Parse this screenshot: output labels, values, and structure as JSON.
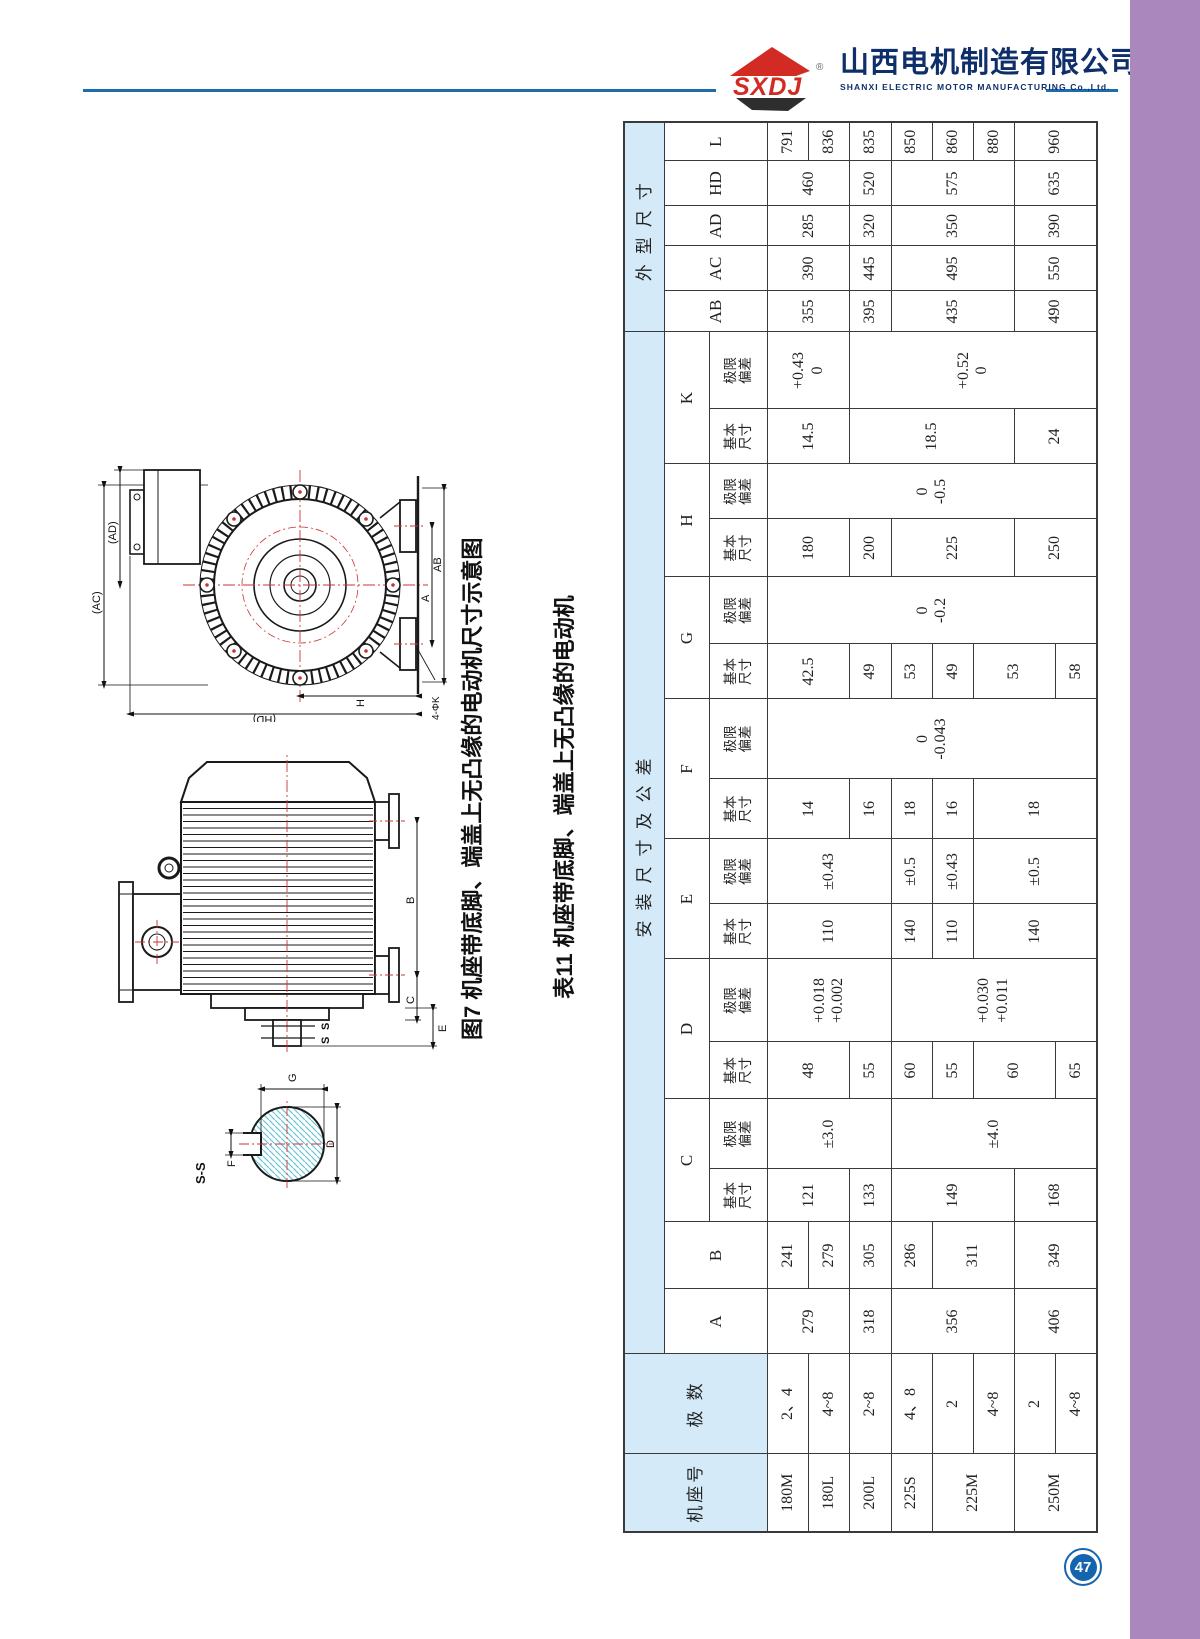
{
  "header": {
    "logo_text": "SXDJ",
    "reg_mark": "®",
    "company_cn": "山西电机制造有限公司",
    "company_en": "SHANXI ELECTRIC MOTOR MANUFACTURING Co.,Ltd.",
    "rule_color": "#1d6dad",
    "logo_red": "#d22b23",
    "logo_dark": "#2e2e2e",
    "text_navy": "#0f2f6b"
  },
  "figure": {
    "caption": "图7 机座带底脚、端盖上无凸缘的电动机尺寸示意图",
    "end_view_labels": {
      "ac": "(AC)",
      "ad": "(AD)",
      "hd": "(HD)",
      "h": "H",
      "a": "A",
      "ab": "AB",
      "k": "4-ΦK"
    },
    "side_view_labels": {
      "b": "B",
      "c": "C",
      "e": "E",
      "s1": "S",
      "s2": "S"
    },
    "section_labels": {
      "title": "S-S",
      "f": "F",
      "g": "G",
      "d": "D"
    }
  },
  "table": {
    "caption": "表11 机座带底脚、端盖上无凸缘的电动机",
    "header_blue": "#d4eaf8",
    "header_rows": [
      [
        {
          "t": "机座号",
          "rs": 3,
          "blue": true,
          "cls": "hd-cn"
        },
        {
          "t": "极 数",
          "rs": 3,
          "blue": true,
          "cls": "hd-cn"
        },
        {
          "t": "安装尺寸及公差",
          "cs": 16,
          "blue": true,
          "cls": "hd-group"
        },
        {
          "t": "外型尺寸",
          "cs": 5,
          "blue": true,
          "cls": "hd-group"
        }
      ],
      [
        {
          "t": "A",
          "rs": 2,
          "cls": "hd-letter"
        },
        {
          "t": "B",
          "rs": 2,
          "cls": "hd-letter"
        },
        {
          "t": "C",
          "cs": 2,
          "cls": "hd-letter"
        },
        {
          "t": "D",
          "cs": 2,
          "cls": "hd-letter"
        },
        {
          "t": "E",
          "cs": 2,
          "cls": "hd-letter"
        },
        {
          "t": "F",
          "cs": 2,
          "cls": "hd-letter"
        },
        {
          "t": "G",
          "cs": 2,
          "cls": "hd-letter"
        },
        {
          "t": "H",
          "cs": 2,
          "cls": "hd-letter"
        },
        {
          "t": "K",
          "cs": 2,
          "cls": "hd-letter"
        },
        {
          "t": "AB",
          "rs": 2,
          "cls": "hd-letter"
        },
        {
          "t": "AC",
          "rs": 2,
          "cls": "hd-letter"
        },
        {
          "t": "AD",
          "rs": 2,
          "cls": "hd-letter"
        },
        {
          "t": "HD",
          "rs": 2,
          "cls": "hd-letter"
        },
        {
          "t": "L",
          "rs": 2,
          "cls": "hd-letter"
        }
      ],
      [
        {
          "t": "基本\n尺寸",
          "cls": "hd-sub"
        },
        {
          "t": "极限\n偏差",
          "cls": "hd-sub"
        },
        {
          "t": "基本\n尺寸",
          "cls": "hd-sub"
        },
        {
          "t": "极限\n偏差",
          "cls": "hd-sub"
        },
        {
          "t": "基本\n尺寸",
          "cls": "hd-sub"
        },
        {
          "t": "极限\n偏差",
          "cls": "hd-sub"
        },
        {
          "t": "基本\n尺寸",
          "cls": "hd-sub"
        },
        {
          "t": "极限\n偏差",
          "cls": "hd-sub"
        },
        {
          "t": "基本\n尺寸",
          "cls": "hd-sub"
        },
        {
          "t": "极限\n偏差",
          "cls": "hd-sub"
        },
        {
          "t": "基本\n尺寸",
          "cls": "hd-sub"
        },
        {
          "t": "极限\n偏差",
          "cls": "hd-sub"
        },
        {
          "t": "基本\n尺寸",
          "cls": "hd-sub"
        },
        {
          "t": "极限\n偏差",
          "cls": "hd-sub"
        }
      ]
    ],
    "body_rows": [
      [
        {
          "t": "180M"
        },
        {
          "t": "2、4"
        },
        {
          "t": "279",
          "rs": 2
        },
        {
          "t": "241"
        },
        {
          "t": "121",
          "rs": 2
        },
        {
          "t": "±3.0",
          "rs": 3
        },
        {
          "t": "48",
          "rs": 2
        },
        {
          "t": "+0.018\n+0.002",
          "rs": 3
        },
        {
          "t": "110",
          "rs": 3
        },
        {
          "t": "±0.43",
          "rs": 3
        },
        {
          "t": "14",
          "rs": 2
        },
        {
          "t": "0\n-0.043",
          "rs": 8
        },
        {
          "t": "42.5",
          "rs": 2
        },
        {
          "t": "0\n-0.2",
          "rs": 8
        },
        {
          "t": "180",
          "rs": 2
        },
        {
          "t": "0\n-0.5",
          "rs": 8
        },
        {
          "t": "14.5",
          "rs": 2
        },
        {
          "t": "+0.43\n0",
          "rs": 2
        },
        {
          "t": "355",
          "rs": 2
        },
        {
          "t": "390",
          "rs": 2
        },
        {
          "t": "285",
          "rs": 2
        },
        {
          "t": "460",
          "rs": 2
        },
        {
          "t": "791"
        }
      ],
      [
        {
          "t": "180L"
        },
        {
          "t": "4~8"
        },
        {
          "t": "279"
        },
        {
          "t": "836"
        }
      ],
      [
        {
          "t": "200L"
        },
        {
          "t": "2~8"
        },
        {
          "t": "318"
        },
        {
          "t": "305"
        },
        {
          "t": "133"
        },
        {
          "t": "55"
        },
        {
          "t": "16"
        },
        {
          "t": "49"
        },
        {
          "t": "200"
        },
        {
          "t": "18.5",
          "rs": 4
        },
        {
          "t": "+0.52\n0",
          "rs": 6
        },
        {
          "t": "395"
        },
        {
          "t": "445"
        },
        {
          "t": "320"
        },
        {
          "t": "520"
        },
        {
          "t": "835"
        }
      ],
      [
        {
          "t": "225S"
        },
        {
          "t": "4、8"
        },
        {
          "t": "356",
          "rs": 3
        },
        {
          "t": "286"
        },
        {
          "t": "149",
          "rs": 3
        },
        {
          "t": "±4.0",
          "rs": 5
        },
        {
          "t": "60"
        },
        {
          "t": "+0.030\n+0.011",
          "rs": 5
        },
        {
          "t": "140"
        },
        {
          "t": "±0.5"
        },
        {
          "t": "18"
        },
        {
          "t": "53"
        },
        {
          "t": "225",
          "rs": 3
        },
        {
          "t": "435",
          "rs": 3
        },
        {
          "t": "495",
          "rs": 3
        },
        {
          "t": "350",
          "rs": 3
        },
        {
          "t": "575",
          "rs": 3
        },
        {
          "t": "850"
        }
      ],
      [
        {
          "t": "225M",
          "rs": 2
        },
        {
          "t": "2"
        },
        {
          "t": "311",
          "rs": 2
        },
        {
          "t": "55"
        },
        {
          "t": "110"
        },
        {
          "t": "±0.43"
        },
        {
          "t": "16"
        },
        {
          "t": "49"
        },
        {
          "t": "860"
        }
      ],
      [
        {
          "t": "4~8"
        },
        {
          "t": "60",
          "rs": 2
        },
        {
          "t": "140",
          "rs": 3
        },
        {
          "t": "±0.5",
          "rs": 3
        },
        {
          "t": "18",
          "rs": 3
        },
        {
          "t": "53",
          "rs": 2
        },
        {
          "t": "880"
        }
      ],
      [
        {
          "t": "250M",
          "rs": 2
        },
        {
          "t": "2"
        },
        {
          "t": "406",
          "rs": 2
        },
        {
          "t": "349",
          "rs": 2
        },
        {
          "t": "168",
          "rs": 2
        },
        {
          "t": "250",
          "rs": 2
        },
        {
          "t": "24",
          "rs": 2
        },
        {
          "t": "490",
          "rs": 2
        },
        {
          "t": "550",
          "rs": 2
        },
        {
          "t": "390",
          "rs": 2
        },
        {
          "t": "635",
          "rs": 2
        },
        {
          "t": "960",
          "rs": 2
        }
      ],
      [
        {
          "t": "4~8"
        },
        {
          "t": "65"
        },
        {
          "t": "58"
        }
      ]
    ]
  },
  "footer": {
    "page_number": "47",
    "badge_color": "#1565ae",
    "sidebar_color": "#aa88be"
  }
}
